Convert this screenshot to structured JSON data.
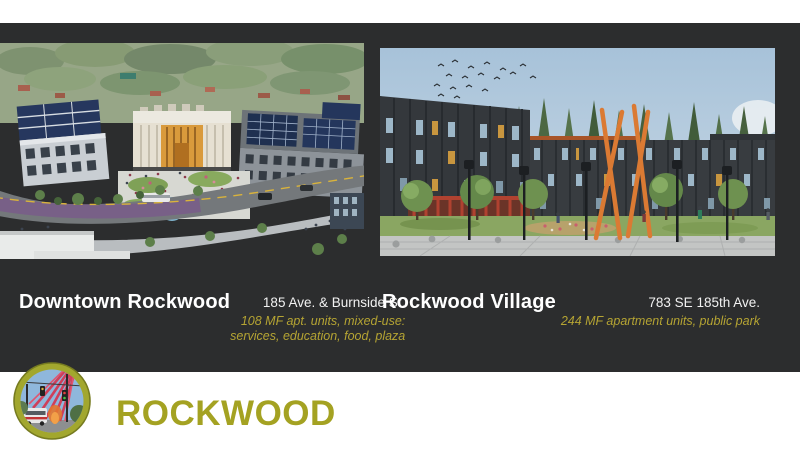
{
  "slide": {
    "panel_color": "#2c2d2e",
    "accent_gold": "#b5a433",
    "brand_olive": "#a4a222",
    "title_color": "#ffffff"
  },
  "projects": [
    {
      "title": "Downtown Rockwood",
      "address": "185 Ave. & Burnside St.",
      "description_lines": [
        "108 MF apt. units, mixed-use:",
        "services, education, food, plaza"
      ],
      "image": "aerial-rendering-downtown-rockwood-mixed-use-plaza"
    },
    {
      "title": "Rockwood Village",
      "address": "783 SE 185th Ave.",
      "description_lines": [
        "244 MF apartment units, public park"
      ],
      "image": "street-rendering-rockwood-village-apartments-park"
    }
  ],
  "footer": {
    "wordmark": "ROCKWOOD",
    "logo": "rockwood-gateway-sculpture-logo"
  }
}
